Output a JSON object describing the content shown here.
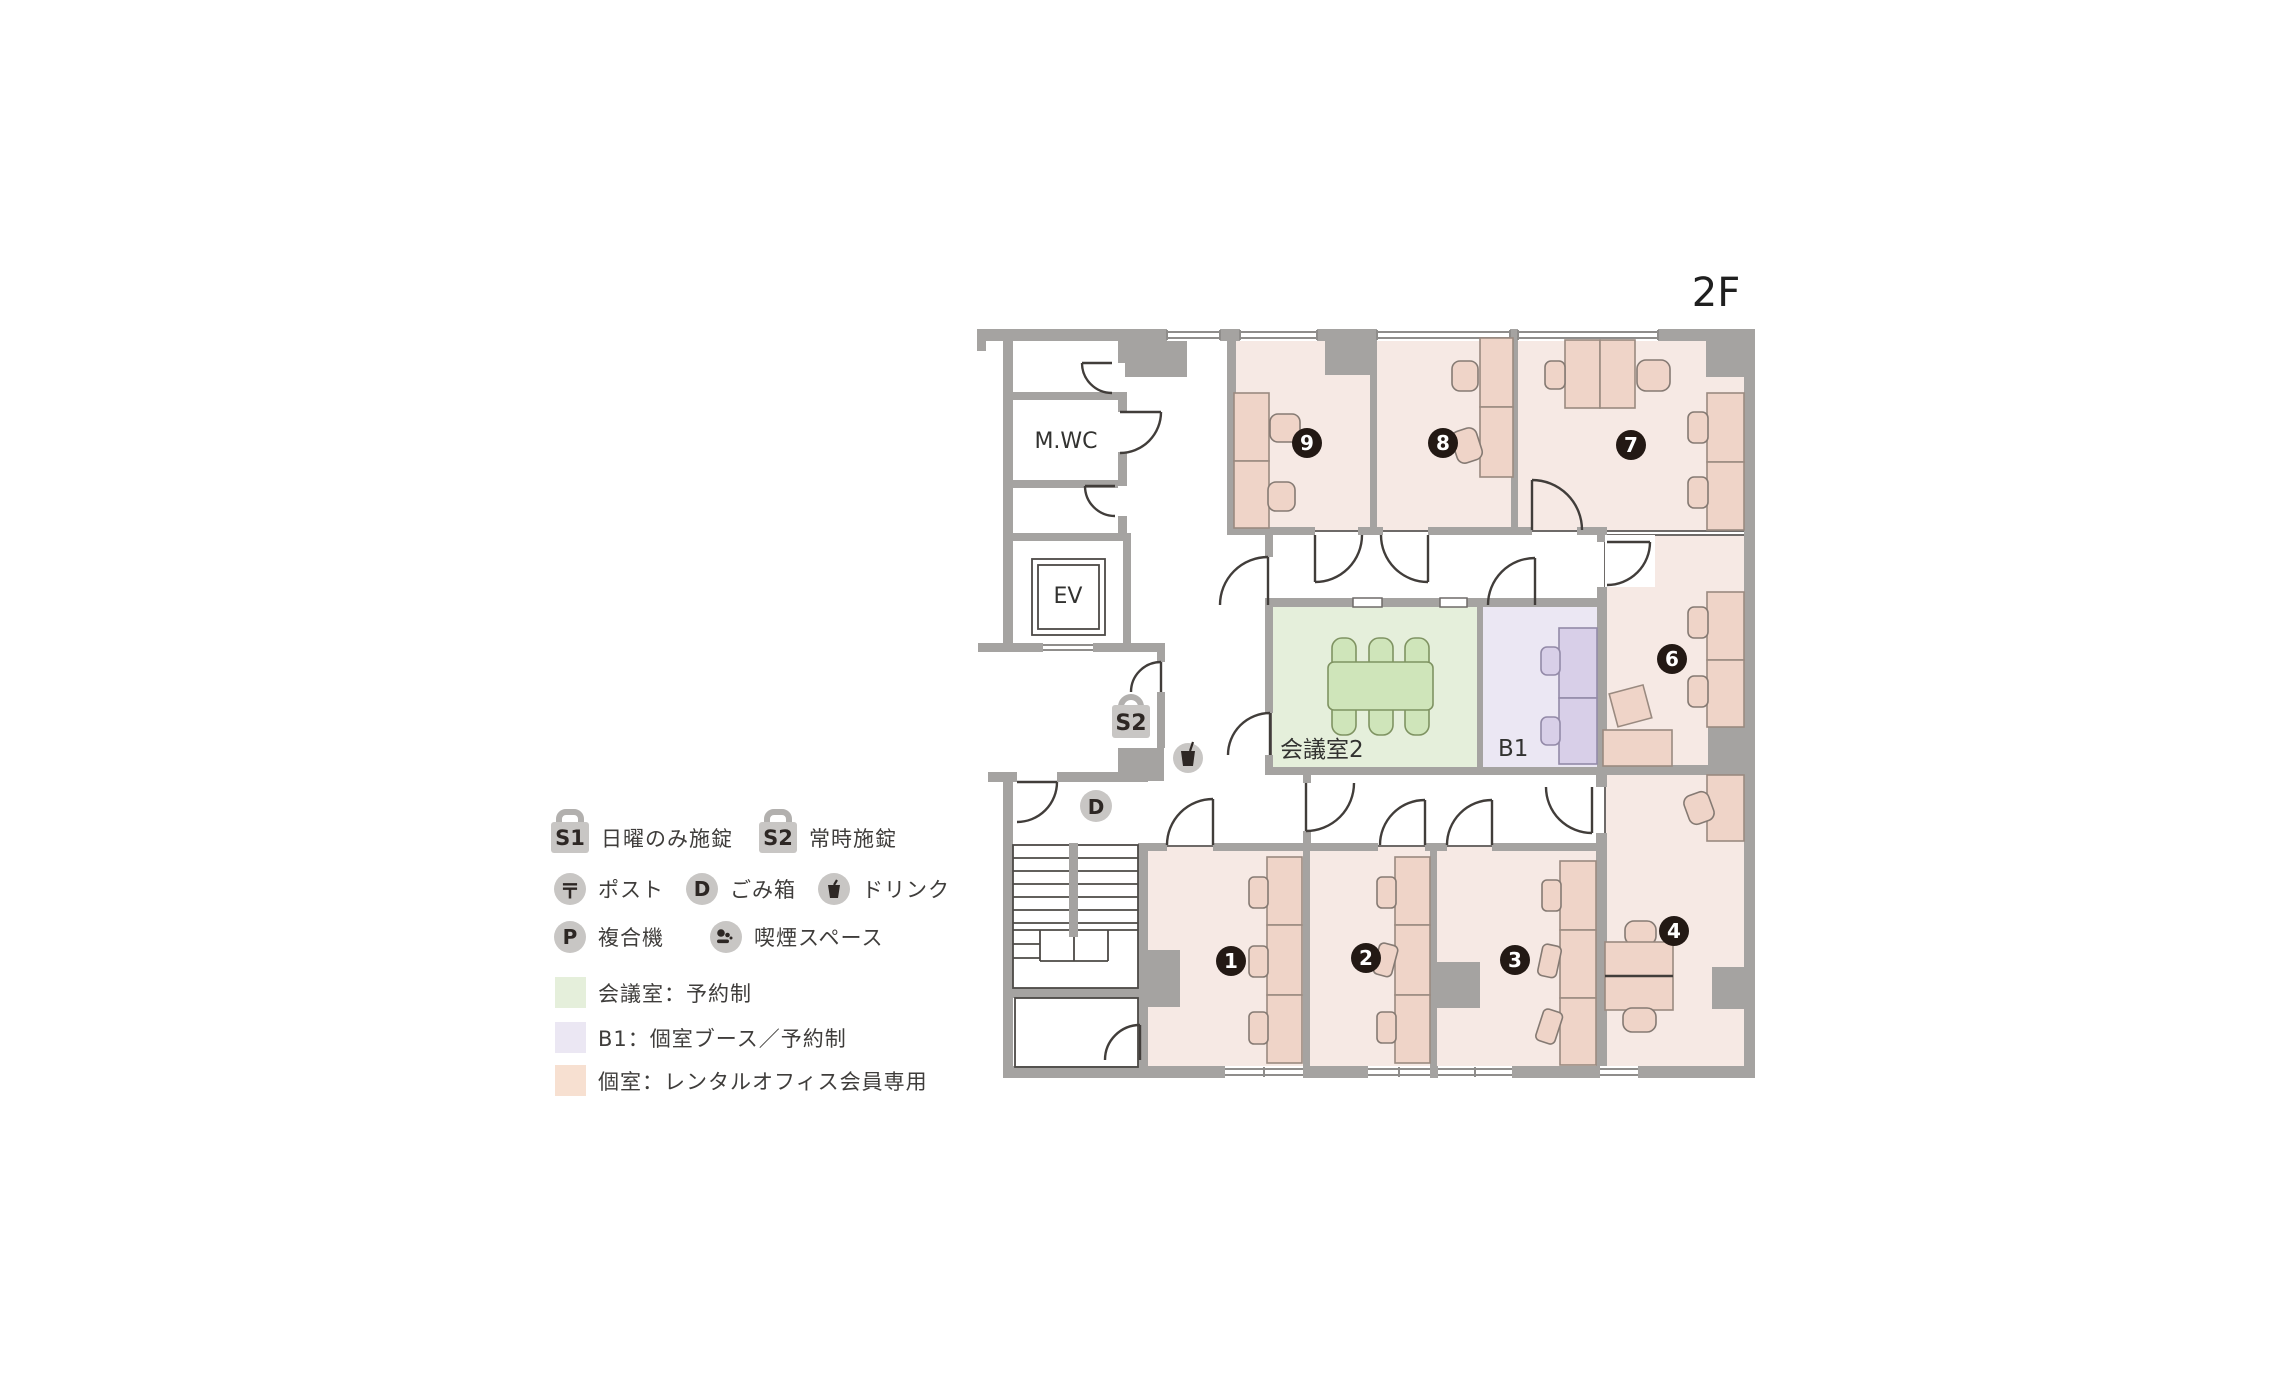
{
  "floor_label": "2F",
  "plan": {
    "room_labels": {
      "mwc": "M.WC",
      "ev": "EV",
      "meeting": "会議室2",
      "booth": "B1"
    },
    "badges": {
      "r1": "1",
      "r2": "2",
      "r3": "3",
      "r4": "4",
      "r6": "6",
      "r7": "7",
      "r8": "8",
      "r9": "9"
    },
    "icons": {
      "lock": "S2",
      "trash": "D"
    }
  },
  "legend": {
    "lock_sunday": {
      "label": "S1",
      "text": "日曜のみ施錠"
    },
    "lock_always": {
      "label": "S2",
      "text": "常時施錠"
    },
    "post": {
      "label": "〒",
      "text": "ポスト"
    },
    "trash": {
      "label": "D",
      "text": "ごみ箱"
    },
    "drink": {
      "text": "ドリンク"
    },
    "printer": {
      "label": "P",
      "text": "複合機"
    },
    "smoking": {
      "text": "喫煙スペース"
    },
    "meeting": {
      "color": "#e5efdb",
      "text": "会議室：予約制"
    },
    "booth": {
      "color": "#ebe7f3",
      "text": "B1：個室ブース／予約制"
    },
    "private": {
      "color": "#f7e0d1",
      "text": "個室：レンタルオフィス会員専用"
    }
  },
  "colors": {
    "wall": "#a5a3a1",
    "private_room": "#f6e9e4",
    "desk": "#efd4c8",
    "meeting_room": "#e5efdb",
    "meeting_table": "#cfe5ba",
    "booth_room": "#ebe7f3",
    "booth_desk": "#d8cfe8",
    "badge_bg": "#231914",
    "badge_text": "#ffffff",
    "icon_bg": "#c8c6c4",
    "icon_glyph": "#2d2724",
    "door_line": "#413d3a"
  }
}
